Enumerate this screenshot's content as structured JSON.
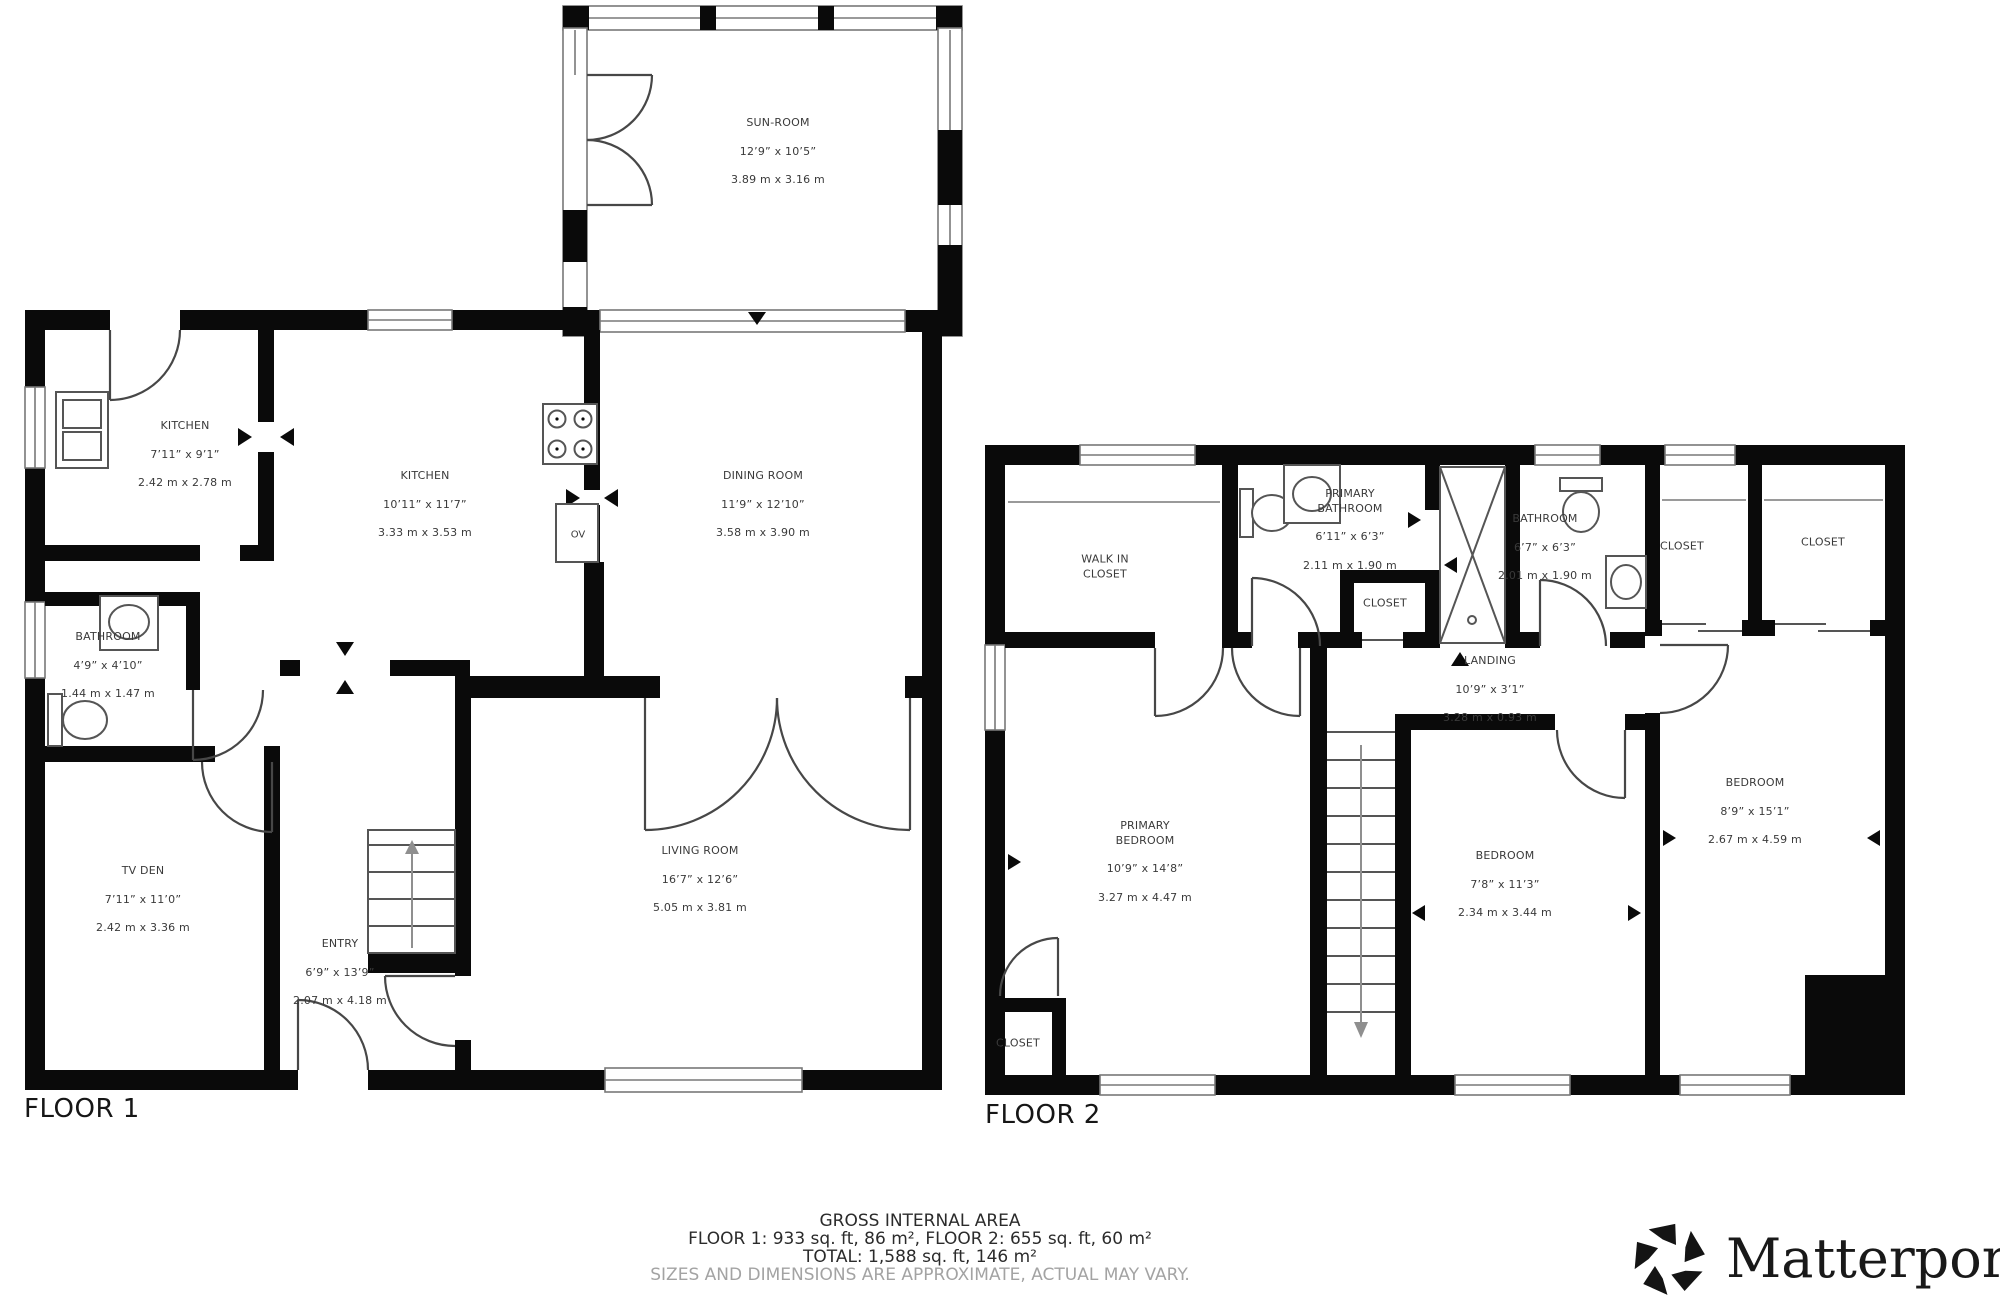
{
  "floor1": {
    "title": "FLOOR 1",
    "oven_label": "OV",
    "rooms": [
      {
        "name": "SUN-ROOM",
        "dim_ft": "12’9” x 10’5”",
        "dim_m": "3.89 m x 3.16 m"
      },
      {
        "name": "KITCHEN",
        "dim_ft": "7’11” x 9’1”",
        "dim_m": "2.42 m x 2.78 m"
      },
      {
        "name": "KITCHEN",
        "dim_ft": "10’11” x 11’7”",
        "dim_m": "3.33 m x 3.53 m"
      },
      {
        "name": "DINING ROOM",
        "dim_ft": "11’9” x 12’10”",
        "dim_m": "3.58 m x 3.90 m"
      },
      {
        "name": "BATHROOM",
        "dim_ft": "4’9” x 4’10”",
        "dim_m": "1.44 m x 1.47 m"
      },
      {
        "name": "TV DEN",
        "dim_ft": "7’11” x 11’0”",
        "dim_m": "2.42 m x 3.36 m"
      },
      {
        "name": "ENTRY",
        "dim_ft": "6’9” x 13’9”",
        "dim_m": "2.07 m x 4.18 m"
      },
      {
        "name": "LIVING ROOM",
        "dim_ft": "16’7” x 12’6”",
        "dim_m": "5.05 m x 3.81 m"
      }
    ]
  },
  "floor2": {
    "title": "FLOOR 2",
    "rooms": [
      {
        "name": "WALK IN\nCLOSET"
      },
      {
        "name": "PRIMARY\nBATHROOM",
        "dim_ft": "6’11” x 6’3”",
        "dim_m": "2.11 m x 1.90 m"
      },
      {
        "name": "CLOSET"
      },
      {
        "name": "BATHROOM",
        "dim_ft": "6’7” x 6’3”",
        "dim_m": "2.01 m x 1.90 m"
      },
      {
        "name": "CLOSET"
      },
      {
        "name": "CLOSET"
      },
      {
        "name": "LANDING",
        "dim_ft": "10’9” x 3’1”",
        "dim_m": "3.28 m x 0.93 m"
      },
      {
        "name": "PRIMARY\nBEDROOM",
        "dim_ft": "10’9” x 14’8”",
        "dim_m": "3.27 m x 4.47 m"
      },
      {
        "name": "BEDROOM",
        "dim_ft": "7’8” x 11’3”",
        "dim_m": "2.34 m x 3.44 m"
      },
      {
        "name": "BEDROOM",
        "dim_ft": "8’9” x 15’1”",
        "dim_m": "2.67 m x 4.59 m"
      },
      {
        "name": "CLOSET"
      }
    ]
  },
  "footer": {
    "line1": "GROSS INTERNAL AREA",
    "line2": "FLOOR 1: 933 sq. ft, 86 m², FLOOR 2: 655 sq. ft, 60 m²",
    "line3": "TOTAL: 1,588 sq. ft, 146 m²",
    "line4": "SIZES AND DIMENSIONS ARE APPROXIMATE, ACTUAL MAY VARY."
  },
  "brand": {
    "name": "Matterport",
    "registered_mark": "®"
  }
}
